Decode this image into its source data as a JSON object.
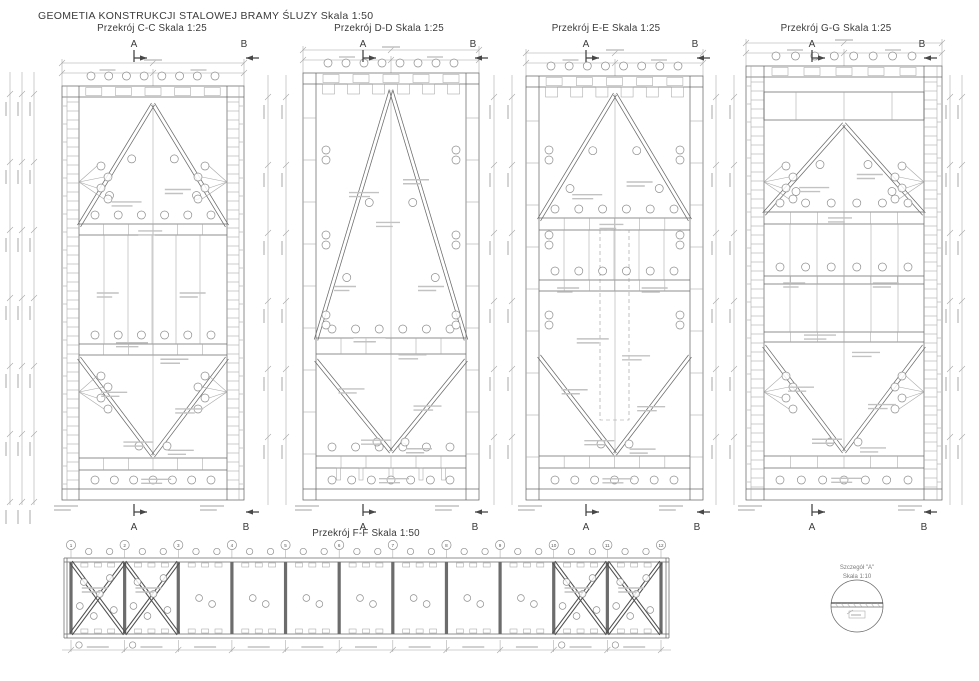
{
  "title": "GEOMETIA KONSTRUKCJI STALOWEJ BRAMY ŚLUZY  Skala 1:50",
  "sections": [
    {
      "id": "C-C",
      "title": "Przekrój C-C Skala 1:25"
    },
    {
      "id": "D-D",
      "title": "Przekrój D-D Skala 1:25"
    },
    {
      "id": "E-E",
      "title": "Przekrój E-E Skala 1:25"
    },
    {
      "id": "G-G",
      "title": "Przekrój G-G Skala 1:25"
    }
  ],
  "section_ff": {
    "title": "Przekrój F-F Skala 1:50",
    "grid_labels": [
      "1",
      "2",
      "3",
      "4",
      "5",
      "6",
      "7",
      "8",
      "9",
      "10",
      "11",
      "12"
    ]
  },
  "detail": {
    "title": "Szczegół \"A\"",
    "scale": "Skala 1:10"
  },
  "markers": {
    "a": "A",
    "b": "B"
  },
  "colors": {
    "background": "#ffffff",
    "line": "#6a6a6a",
    "line_dark": "#474747",
    "line_light": "#a6a6a6",
    "text": "#3b3b3b"
  }
}
